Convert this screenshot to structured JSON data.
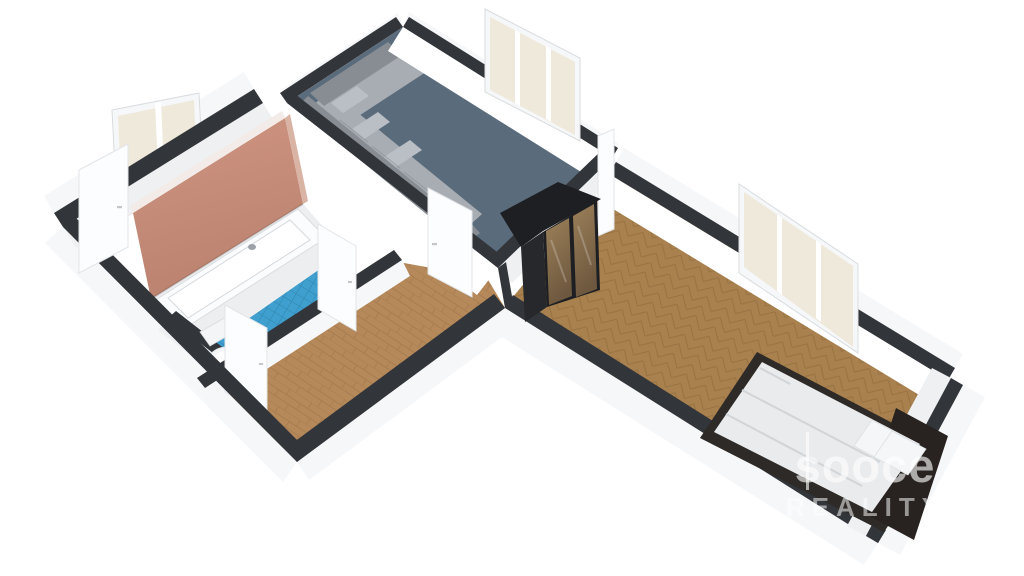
{
  "scene": {
    "type": "isometric-3d-floor-plan",
    "description": "3D rendered floor plan of a one-bedroom apartment viewed from above at an angle",
    "background": "white"
  },
  "watermark": {
    "logo": "sooce",
    "sub": "REALITY"
  },
  "rooms": [
    {
      "name": "living-room",
      "floor": "blue-gray"
    },
    {
      "name": "bedroom",
      "floor": "herringbone-parquet"
    },
    {
      "name": "bathroom",
      "floor": "blue-tile"
    },
    {
      "name": "wc",
      "floor": "blue-tile"
    },
    {
      "name": "hallway",
      "floor": "wood-plank"
    },
    {
      "name": "entry-strip",
      "floor": "wood-plank"
    }
  ],
  "furniture": [
    {
      "name": "corner-sofa",
      "room": "living-room"
    },
    {
      "name": "sliding-door-wardrobe",
      "room": "bedroom"
    },
    {
      "name": "double-bed",
      "room": "bedroom"
    },
    {
      "name": "bathtub",
      "room": "bathroom"
    },
    {
      "name": "washbasin-vanity",
      "room": "entry-strip"
    },
    {
      "name": "toilet",
      "room": "wc"
    }
  ],
  "openings": [
    {
      "name": "entry-door",
      "state": "open"
    },
    {
      "name": "living-room-door",
      "state": "open"
    },
    {
      "name": "bathroom-door",
      "state": "open"
    },
    {
      "name": "wc-door",
      "state": "open"
    },
    {
      "name": "bedroom-door",
      "state": "open"
    },
    {
      "name": "window-entry",
      "panes": 2
    },
    {
      "name": "window-living",
      "panes": 3
    },
    {
      "name": "window-bedroom",
      "panes": 3
    }
  ],
  "colors": {
    "bg": "#ffffff",
    "wall_top": "#323539",
    "wall_face": "#ffffff",
    "wall_face_dim": "#eef0f2",
    "ext_face": "#f6f7f9",
    "floor_living": "#5a6b7c",
    "floor_wood": "#b5895a",
    "wood_line": "#9c7347",
    "floor_herr": "#a8814e",
    "herr_line": "#8a6337",
    "tile_blue": "#3f9fce",
    "tile_line": "#2e7fa8",
    "accent_hi": "#cf9582",
    "accent_lo": "#bb8270",
    "sofa_dark": "#878d93",
    "sofa_mid": "#a7adb3",
    "sofa_light": "#b9bfc5",
    "wardrobe_frame": "#1d1f22",
    "wardrobe_side": "#26282c",
    "wardrobe_top": "#35373b",
    "wardrobe_door_hi": "#9c8059",
    "wardrobe_door_lo": "#6e583f",
    "bed_frame": "#2e2a27",
    "bedding": "#e9ebed",
    "pillow": "#f4f6f7",
    "headboard": "#282320",
    "door_white": "#fcfdfe",
    "door_edge": "#e2e5e8",
    "window_frame": "#f6f7f8",
    "glass": "#efe9dc",
    "watermark": "rgba(255,255,255,0.62)"
  }
}
